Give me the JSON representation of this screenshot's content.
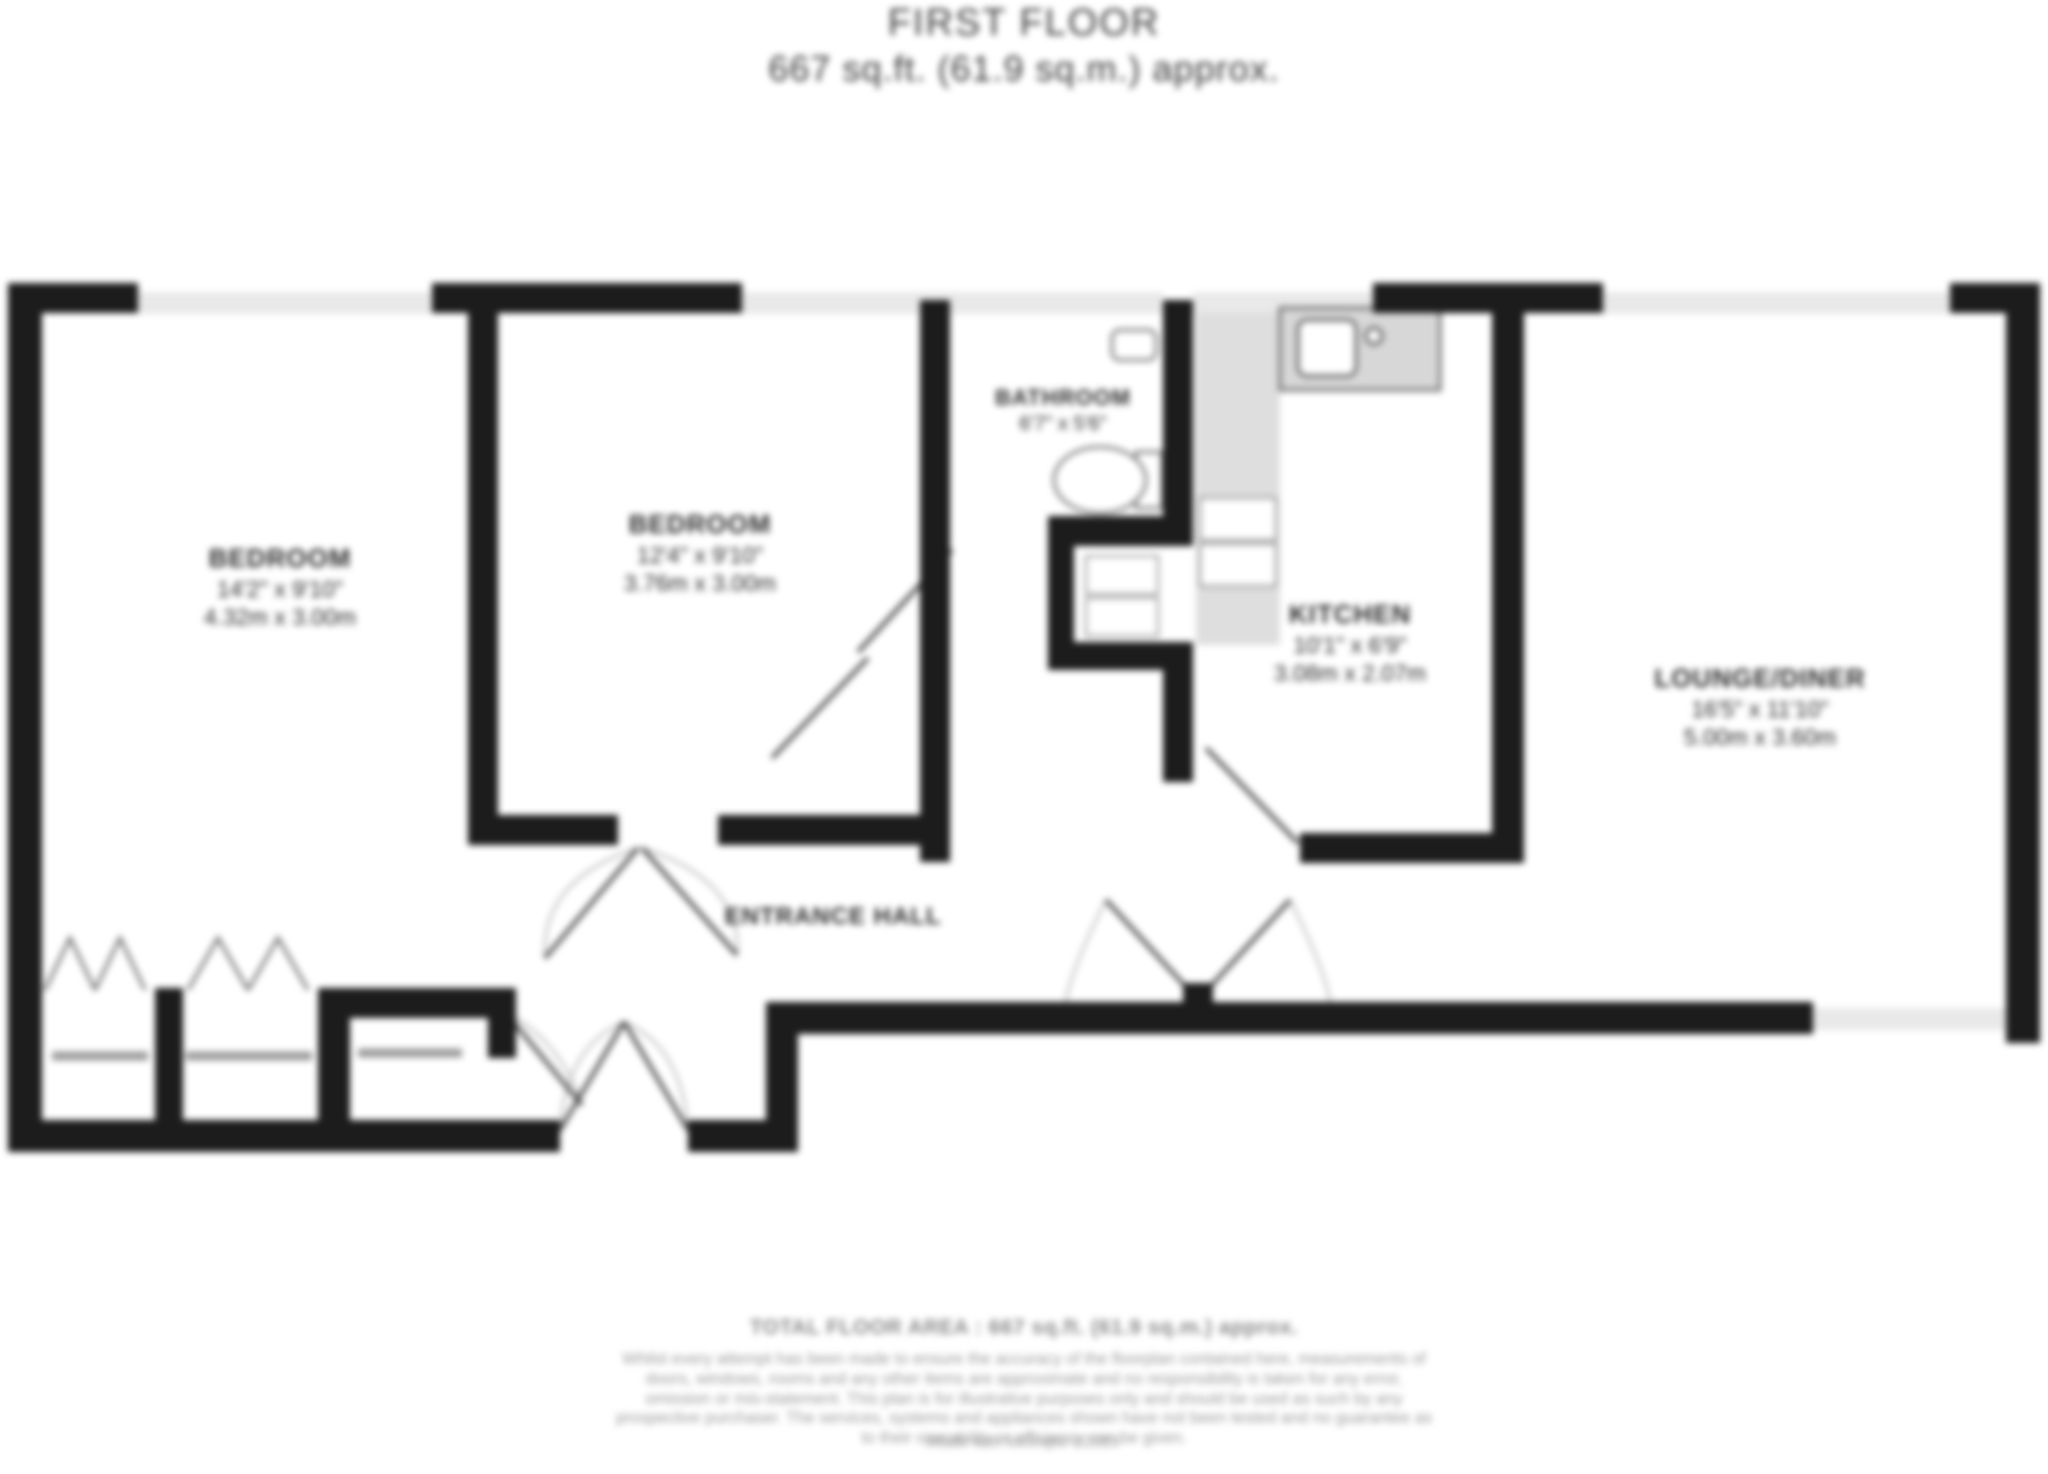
{
  "header": {
    "title": "FIRST FLOOR",
    "subtitle": "667 sq.ft. (61.9 sq.m.) approx."
  },
  "rooms": [
    {
      "id": "bedroom-1",
      "name": "BEDROOM",
      "dims_imperial": "14'2\" x 9'10\"",
      "dims_metric": "4.32m x 3.00m"
    },
    {
      "id": "bedroom-2",
      "name": "BEDROOM",
      "dims_imperial": "12'4\" x 9'10\"",
      "dims_metric": "3.76m x 3.00m"
    },
    {
      "id": "bathroom",
      "name": "BATHROOM",
      "dims_imperial": "6'7\" x 5'6\"",
      "dims_metric": ""
    },
    {
      "id": "kitchen",
      "name": "KITCHEN",
      "dims_imperial": "10'1\" x 6'9\"",
      "dims_metric": "3.08m x 2.07m"
    },
    {
      "id": "lounge",
      "name": "LOUNGE/DINER",
      "dims_imperial": "16'5\" x 11'10\"",
      "dims_metric": "5.00m x 3.60m"
    },
    {
      "id": "entrance-hall",
      "name": "ENTRANCE HALL"
    }
  ],
  "footer": {
    "total": "TOTAL FLOOR AREA : 667 sq.ft. (61.9 sq.m.) approx.",
    "disclaimer": "Whilst every attempt has been made to ensure the accuracy of the floorplan contained here, measurements of doors, windows, rooms and any other items are approximate and no responsibility is taken for any error, omission or mis-statement. This plan is for illustrative purposes only and should be used as such by any prospective purchaser. The services, systems and appliances shown have not been tested and no guarantee as to their operability or efficiency can be given.",
    "made_with": "Made with Metropix ©2019"
  },
  "colors": {
    "wall": "#1c1c1c",
    "window": "#e9e9e9",
    "fixture_gray": "#d9d9d9",
    "text_dark": "#2b2b2b",
    "text_gray": "#9a9a9a"
  }
}
